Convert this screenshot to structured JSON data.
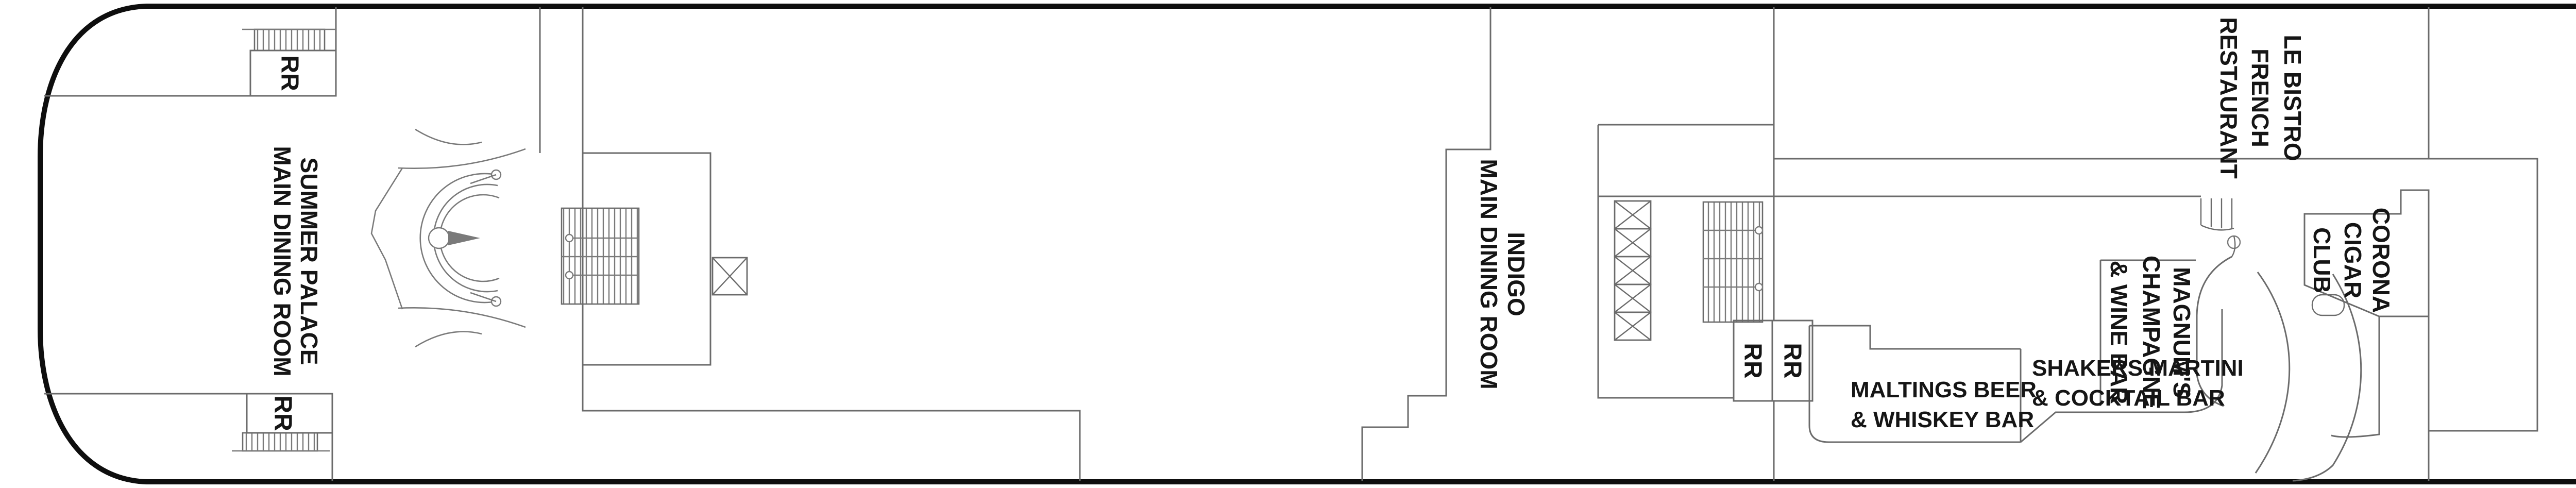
{
  "app": {
    "name": "cruise-ship-deck-plan"
  },
  "colors": {
    "wall": "#6b6b6b",
    "hull": "#0e0e0e",
    "text": "#151515",
    "background": "#ffffff"
  },
  "labels": {
    "summer_palace": {
      "lines": [
        "SUMMER PALACE",
        "MAIN DINING ROOM"
      ]
    },
    "indigo": {
      "lines": [
        "INDIGO",
        "MAIN DINING ROOM"
      ]
    },
    "le_bistro": {
      "lines": [
        "LE BISTRO",
        "FRENCH",
        "RESTAURANT"
      ]
    },
    "maltings": {
      "lines": [
        "MALTINGS BEER",
        "& WHISKEY BAR"
      ]
    },
    "shakers": {
      "lines": [
        "SHAKERS MARTINI",
        "& COCKTAIL BAR"
      ]
    },
    "magnums": {
      "lines": [
        "MAGNUM'S",
        "CHAMPAGNE",
        "& WINE BAR"
      ]
    },
    "corona": {
      "lines": [
        "CORONA",
        "CIGAR",
        "CLUB"
      ]
    },
    "casino": {
      "lines": [
        "CASINO"
      ]
    },
    "barcelona": {
      "lines": [
        "BARCELONA",
        "MEETING",
        "ROOM"
      ]
    },
    "prague": {
      "lines": [
        "PRAGUE",
        "MEETING",
        "ROOM"
      ]
    },
    "vienna": {
      "lines": [
        "VIENNA",
        "MEETING",
        "ROOM"
      ]
    },
    "stardust": {
      "lines": [
        "STARDUST",
        "THEATER",
        "(BALCONY)"
      ]
    },
    "open_to_deck_below": {
      "lines": [
        "OPEN TO",
        "DECK BELOW"
      ]
    },
    "stage": {
      "lines": [
        "STAGE"
      ]
    },
    "restroom": "RR"
  }
}
